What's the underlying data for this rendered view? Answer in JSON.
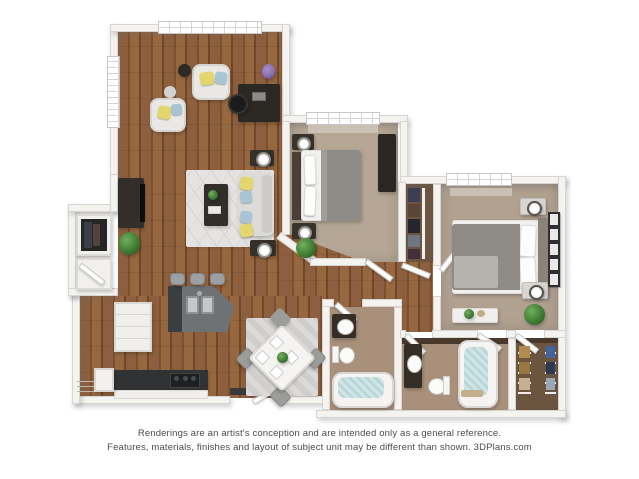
{
  "disclaimer": {
    "line1": "Renderings are an artist's conception and are intended only as a general reference.",
    "line2": "Features, materials, finishes and layout of subject unit may be different than shown. 3DPlans.com"
  },
  "palette": {
    "wall": "#f4f3f0",
    "wallEdge": "#d7d5d2",
    "woodA": "#8d5f3e",
    "woodB": "#7a5031",
    "woodC": "#97683f",
    "woodD": "#6f4829",
    "carpet1": "#b5a695",
    "carpet2": "#b1a191",
    "bathFloor": "#a8907a",
    "closetFloor": "#6b5540",
    "accentWall": "#4a392b",
    "counter": "#6e7274",
    "cabinetDark": "#303234",
    "cabinetWhite": "#f1efec",
    "sofa": "#dcdbd8",
    "rug": "#e4e3e1",
    "rugDining": "#cfcecc",
    "pillowYellow": "#e3d66e",
    "pillowBlue": "#a9c5d4",
    "plantGreen": "#3f7d33",
    "water": "#b9d6d8",
    "furnDark": "#332e29",
    "bedWhite": "#f1f0ee",
    "bedGray": "#8f8c88",
    "windowGrid": "#d5d5d3",
    "textColor": "#4b4b4b"
  }
}
